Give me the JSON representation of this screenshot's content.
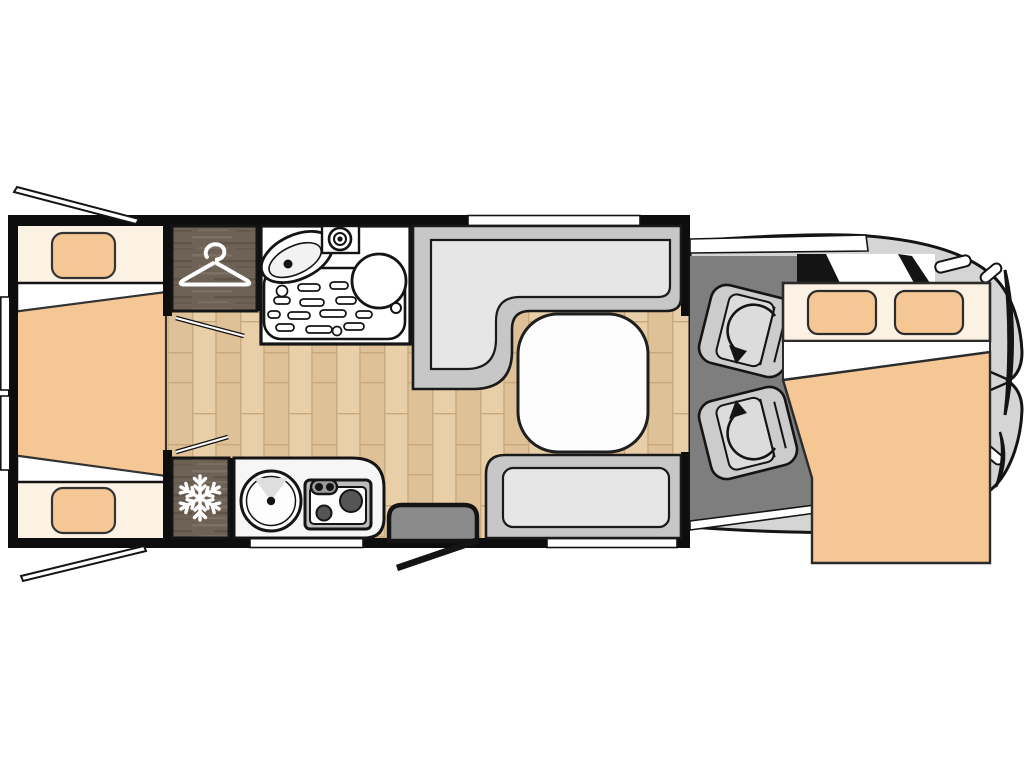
{
  "title": "motorhome-floorplan",
  "labels": {
    "floorplan": "Motorhome floor plan, top view",
    "rear_bedroom": "Rear twin single beds with centre infill mattress",
    "rear_window_top": "Opened rear window (driver side)",
    "rear_window_bottom": "Opened rear window (passenger side)",
    "wardrobe": "Wardrobe",
    "bathroom": "Bathroom with shower tray, washbasin and toilet",
    "fridge": "Refrigerator",
    "kitchen": "Kitchen block with round sink and two-burner hob",
    "entry": "Entrance step and open entry door",
    "dinette": "L-shaped dinette bench, side bench and table",
    "table": "Dinette table",
    "cab": "Driver cab with two swivel seats",
    "driver_seat": "Swivelling driver seat",
    "passenger_seat": "Swivelling passenger seat",
    "drop_down_bed": "Pull-down double bed over cab"
  },
  "icons": {
    "hanger": "coat-hanger-icon",
    "snowflake": "snowflake-fridge-icon",
    "swivel_arrows": "seat-rotation-arrow-icon",
    "shower_head": "shower-head-icon"
  },
  "colors": {
    "outline": "#141414",
    "wall": "#0d0d0d",
    "bedding_tan": "#f5c795",
    "bedding_cream": "#fbf2e3",
    "bed_base": "#ffffff",
    "wood_light": "#e8cfa8",
    "wood_dark": "#dfc198",
    "wood_joint": "#c8a87d",
    "cabinet_wood": "#6d6255",
    "cabinet_wood_light": "#7b7063",
    "cabinet_wood_shadow": "#5e5449",
    "bench_frame": "#c7c7c7",
    "bench_cushion": "#e6e6e6",
    "cab_floor": "#7e7e7e",
    "cab_body": "#d5d5d5",
    "entry_step": "#8a8a8a",
    "hob_frame": "#bdbdbd",
    "burner": "#555555",
    "icon_white": "#ffffff"
  }
}
